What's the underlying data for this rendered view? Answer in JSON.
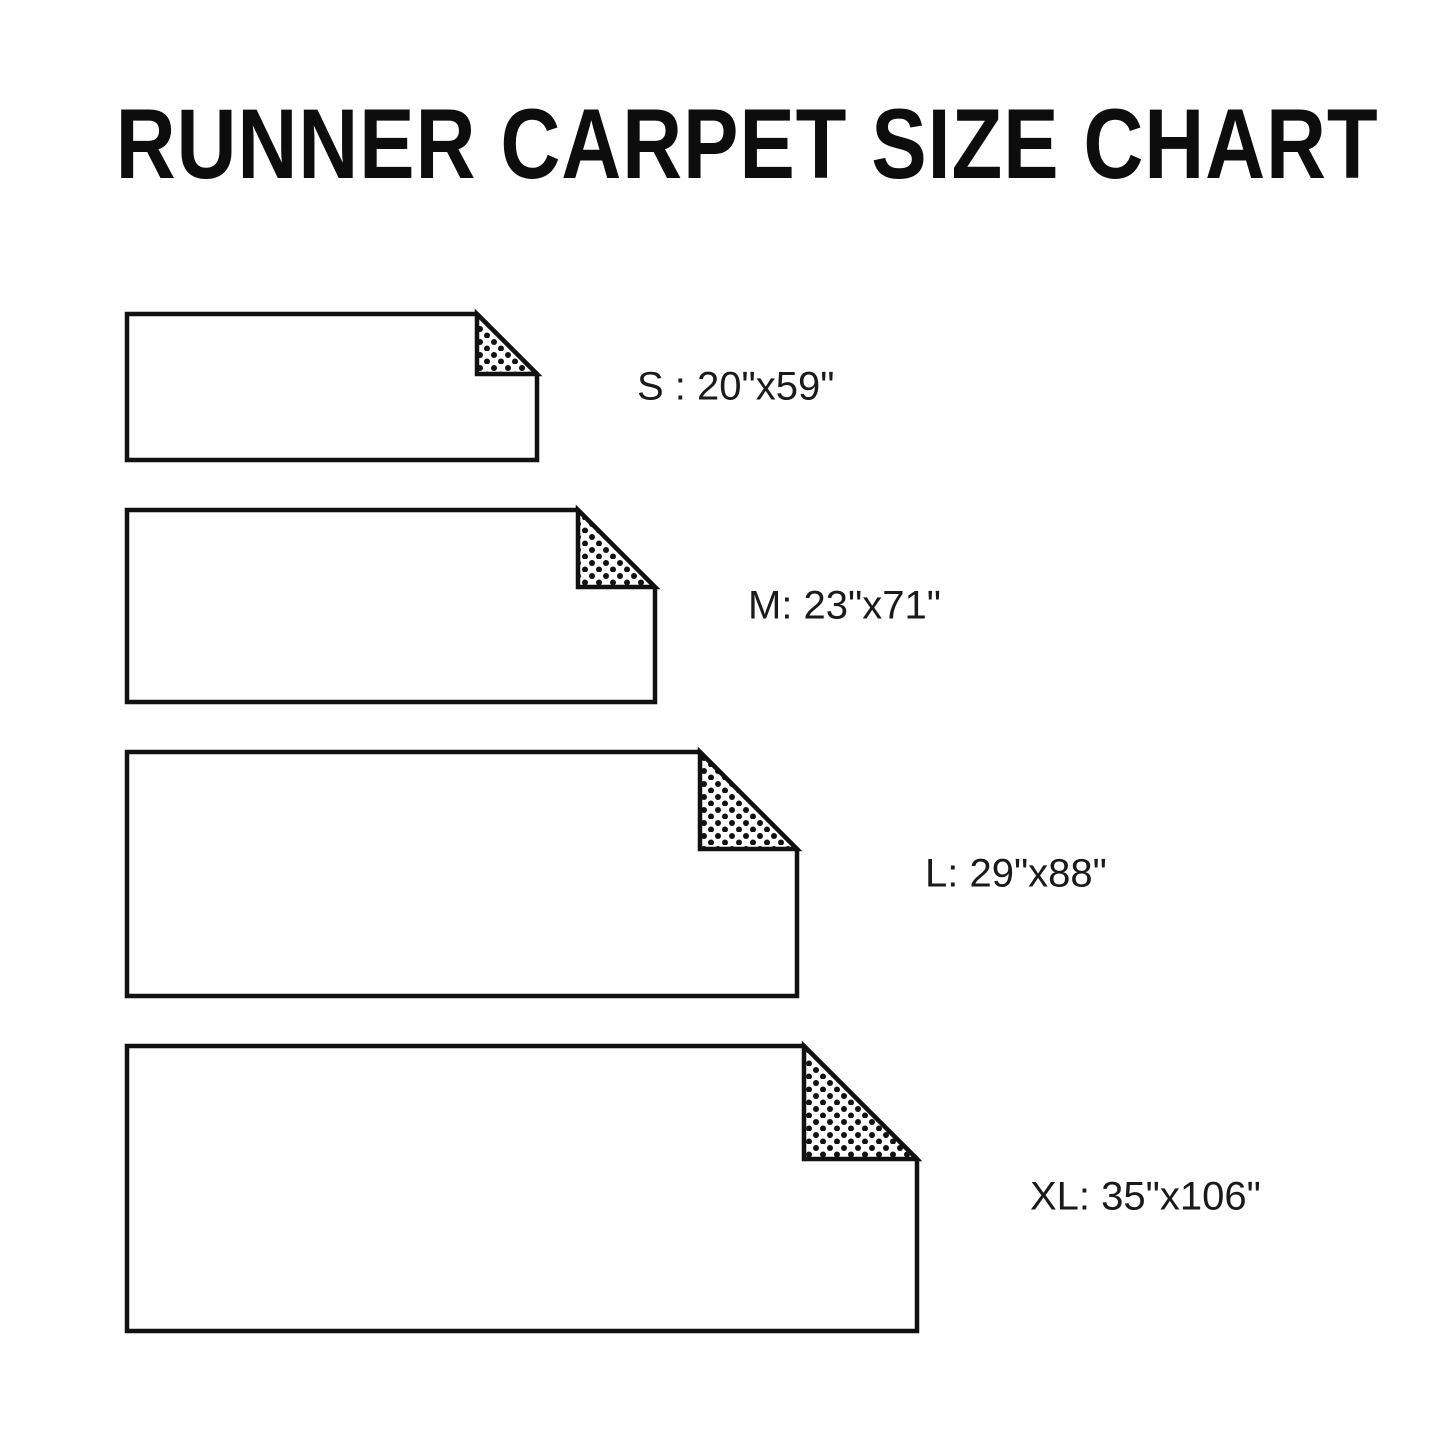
{
  "title": "RUNNER CARPET SIZE CHART",
  "colors": {
    "background": "#ffffff",
    "title_text": "#0d0d0d",
    "label_text": "#1a1a1a",
    "outline": "#111111",
    "carpet_fill": "#ffffff",
    "fold_dots": "#111111"
  },
  "sizes": [
    {
      "code": "S",
      "label": "S : 20\"x59\"",
      "width_in": 20,
      "length_in": 59
    },
    {
      "code": "M",
      "label": "M: 23\"x71\"",
      "width_in": 23,
      "length_in": 71
    },
    {
      "code": "L",
      "label": "L: 29\"x88\"",
      "width_in": 29,
      "length_in": 88
    },
    {
      "code": "XL",
      "label": "XL: 35\"x106\"",
      "width_in": 35,
      "length_in": 106
    }
  ]
}
